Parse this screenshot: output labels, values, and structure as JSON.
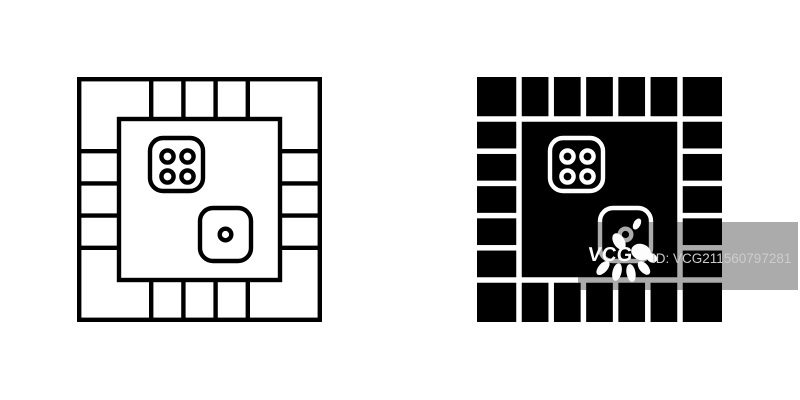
{
  "page": {
    "background_color": "#ffffff"
  },
  "icons": [
    {
      "name": "board-game-icon-outline",
      "style": "outline",
      "color": "#000000",
      "x": 77,
      "y": 77,
      "size": 245,
      "board": {
        "corner_cells": 4,
        "edge_cells_per_side": 5,
        "border_thickness": 42
      },
      "dice": [
        {
          "pips": 4
        },
        {
          "pips": 1
        }
      ]
    },
    {
      "name": "board-game-icon-solid",
      "style": "solid",
      "color": "#000000",
      "x": 477,
      "y": 77,
      "size": 245,
      "board": {
        "corner_cells": 4,
        "edge_cells_per_side": 5,
        "border_thickness": 42
      },
      "dice": [
        {
          "pips": 4
        },
        {
          "pips": 1
        }
      ]
    }
  ],
  "watermark": {
    "band": {
      "x": 578,
      "y": 222,
      "width": 220,
      "height": 68,
      "overlay_color": "rgba(0,0,0,0.33)"
    },
    "logo_text": "VCG",
    "logo_color": "#fdfdfd",
    "id_text": "ID: VCG211560797281",
    "id_text_color": "#cccccc"
  }
}
